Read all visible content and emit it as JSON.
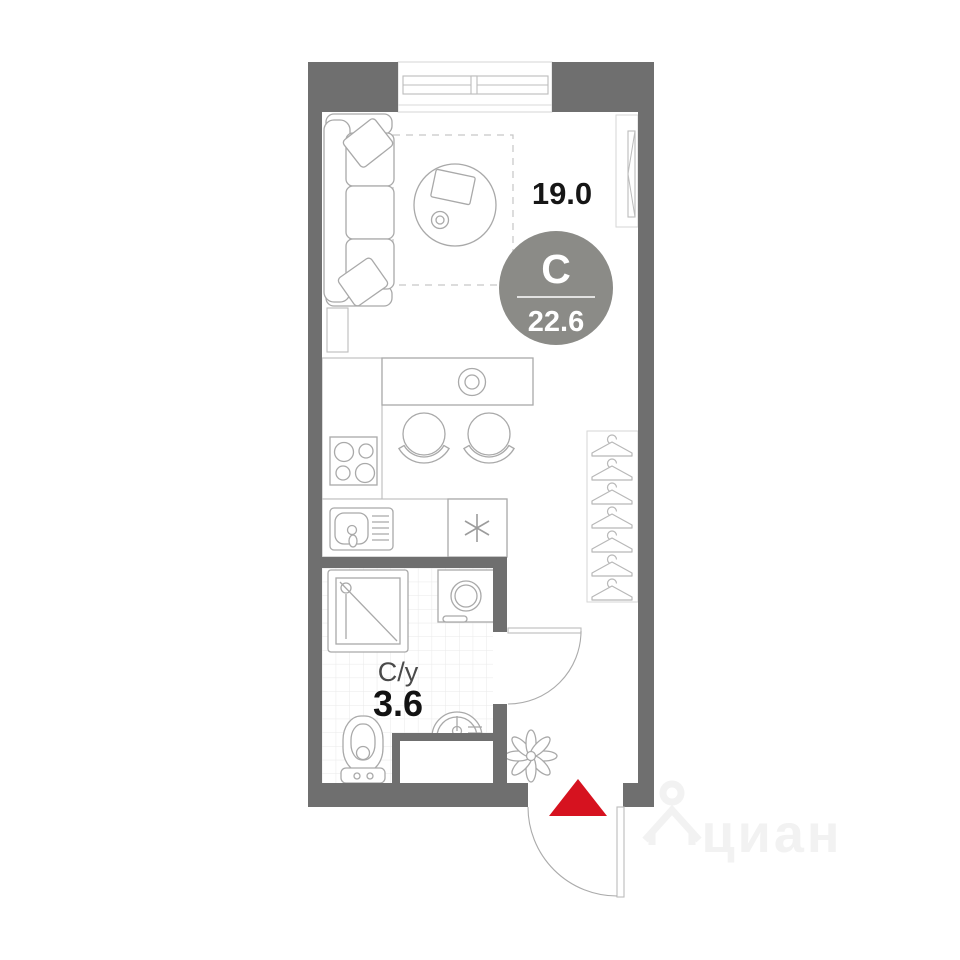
{
  "plan": {
    "labels": {
      "living_area": "19.0",
      "type_letter": "С",
      "total_area": "22.6",
      "bathroom_name": "С/у",
      "bathroom_area": "3.6"
    },
    "watermark": "циан",
    "colors": {
      "wall": "#6f6f6f",
      "badge": "#8b8b87",
      "entrance_arrow": "#d6121f",
      "watermark": "#f2f2f2"
    },
    "legend": {
      "type": "studio floor plan",
      "fixtures": [
        "sofa",
        "round-table",
        "window",
        "wall-panel",
        "bar-table",
        "bar-stools",
        "stove",
        "kitchen-sink",
        "fridge",
        "wardrobe-hangers",
        "shower",
        "washing-machine",
        "toilet",
        "bathroom-sink",
        "vent-shaft",
        "plant",
        "bathroom-door",
        "entrance-door"
      ]
    }
  }
}
